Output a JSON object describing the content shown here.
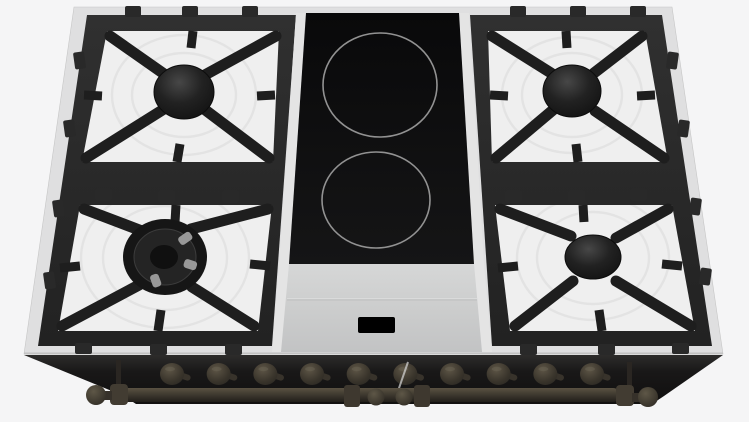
{
  "scene": {
    "description": "Top-down product render of a 90 cm dual-fuel range cooktop: four black cast-iron gas burner grates on white enamel trays (left and right), a central black ceramic panel with two induction zones, a stainless front apron with a small black display window, and a dark front control panel with ten knobs and a rail handle with ball finials."
  },
  "colors": {
    "background": "#f5f5f6",
    "trim": "#dfdfe0",
    "trim_edge": "#c2c2c2",
    "enamel": "#efefef",
    "enamel_ring": "#e1e1e1",
    "grate": "#1e1e1e",
    "grate_frame": "#292929",
    "rail": "#e4e4e4",
    "ceramic": "#0b0b0c",
    "ring": "#929292",
    "apron": "#cfd0d0",
    "apron_seam": "#bdbebe",
    "display": "#000000",
    "front_panel": "#1c1b1a",
    "knob": "#4a443a",
    "handle": "#3d372e"
  },
  "cooktop": {
    "gas_burners": [
      {
        "id": "rear-left",
        "type": "gas-burner",
        "size": "standard"
      },
      {
        "id": "front-left",
        "type": "gas-wok-burner",
        "size": "large"
      },
      {
        "id": "rear-right",
        "type": "gas-burner",
        "size": "standard"
      },
      {
        "id": "front-right",
        "type": "gas-burner",
        "size": "standard"
      }
    ],
    "ceramic_module": {
      "zones": [
        {
          "id": "rear-induction-zone"
        },
        {
          "id": "front-induction-zone"
        }
      ],
      "display_window": true
    }
  },
  "control_panel": {
    "knob_count": 10,
    "handle_finials": 2,
    "door_seam": true
  }
}
